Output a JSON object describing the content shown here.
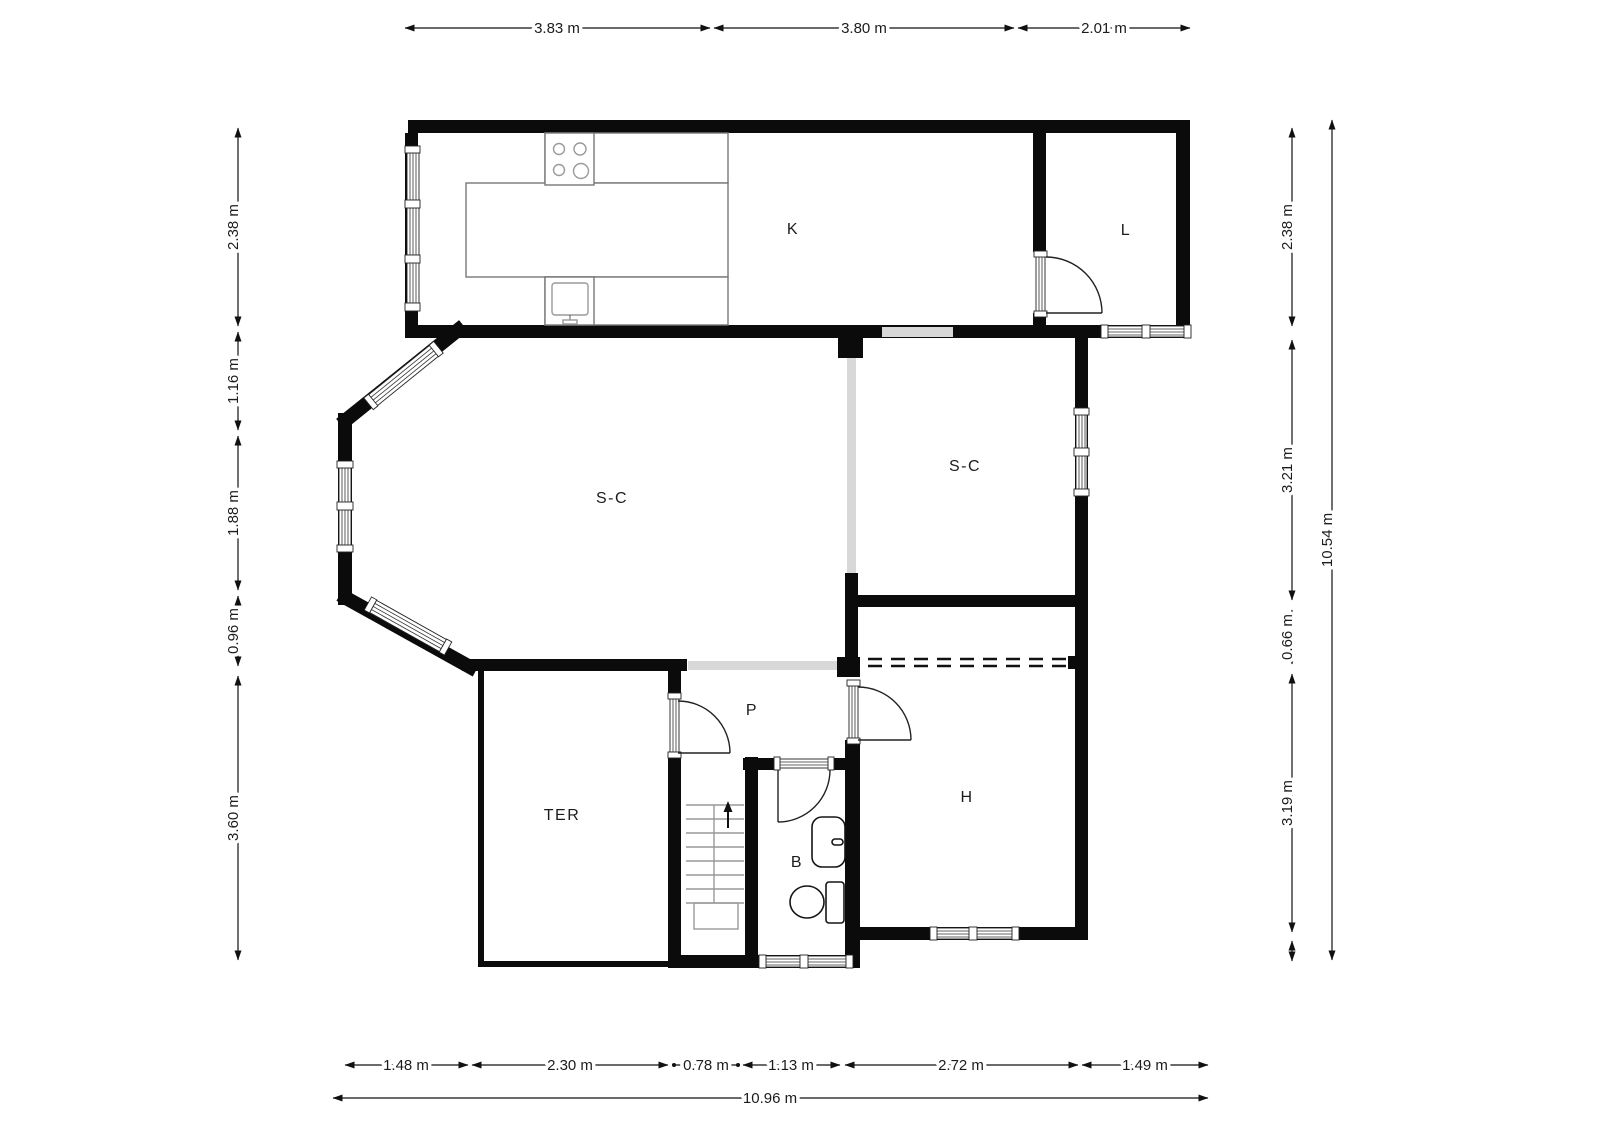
{
  "plan": {
    "rooms": [
      {
        "id": "kitchen",
        "label": "K"
      },
      {
        "id": "laundry",
        "label": "L"
      },
      {
        "id": "living-left",
        "label": "S-C"
      },
      {
        "id": "living-right",
        "label": "S-C"
      },
      {
        "id": "hallway",
        "label": "P"
      },
      {
        "id": "terrace",
        "label": "TER"
      },
      {
        "id": "bathroom",
        "label": "B"
      },
      {
        "id": "bedroom",
        "label": "H"
      }
    ],
    "dims": {
      "top": [
        "3.83 m",
        "3.80 m",
        "2.01 m"
      ],
      "left": [
        "2.38 m",
        "1.16 m",
        "1.88 m",
        "0.96 m",
        "3.60 m"
      ],
      "right": [
        "2.38 m",
        "3.21 m",
        "0.66 m",
        "3.19 m"
      ],
      "right_total": "10.54 m",
      "bottom": [
        "1.48 m",
        "2.30 m",
        "0.78 m",
        "1.13 m",
        "2.72 m",
        "1.49 m"
      ],
      "bottom_total": "10.96 m"
    },
    "colors": {
      "wall": "#0b0b0b",
      "opening": "#d8d8d8",
      "dimension": "#111111"
    }
  }
}
